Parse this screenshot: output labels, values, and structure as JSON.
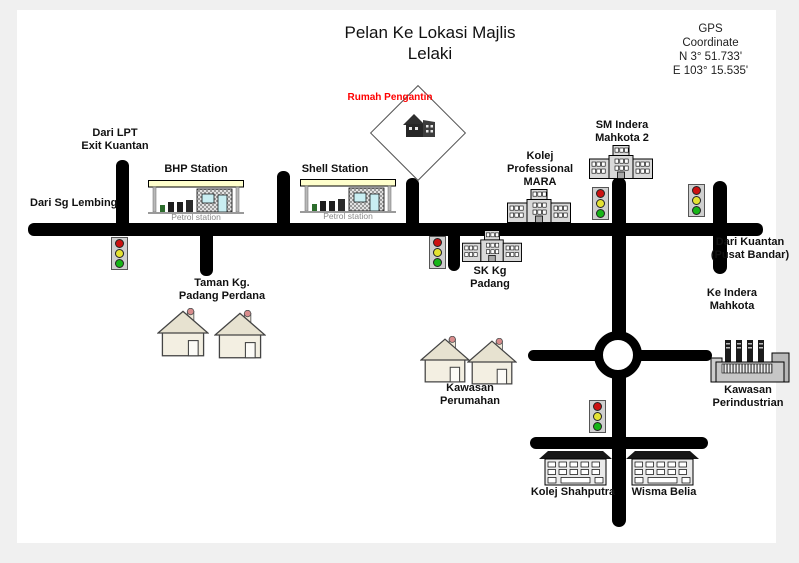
{
  "title": "Pelan Ke Lokasi Majlis\nLelaki",
  "gps_coordinate": "GPS\nCoordinate\nN 3° 51.733'\nE 103° 15.535'",
  "labels": {
    "dari_lpt": "Dari LPT\nExit Kuantan",
    "dari_sg_lembing": "Dari Sg Lembing",
    "bhp_station": "BHP Station",
    "shell_station": "Shell Station",
    "petrol_station": "Petrol station",
    "rumah_pengantin": "Rumah Pengantin",
    "taman_kg_padang_perdana": "Taman Kg.\nPadang Perdana",
    "kolej_professional_mara": "Kolej\nProfessional\nMARA",
    "sm_indera_mahkota_2": "SM Indera\nMahkota 2",
    "sk_kg_padang": "SK Kg\nPadang",
    "dari_kuantan_pusat_bandar": "Dari Kuantan\n(Pusat Bandar)",
    "ke_indera_mahkota": "Ke Indera\nMahkota",
    "kawasan_perumahan": "Kawasan\nPerumahan",
    "kawasan_perindustrian": "Kawasan\nPerindustrian",
    "kolej_shahputra": "Kolej Shahputra",
    "wisma_belia": "Wisma Belia"
  },
  "colors": {
    "road": "#000000",
    "highlight_label_red": "#ff0000",
    "petrol_canopy_yellow": "#ffffcc",
    "traffic_light_red": "#cc1111",
    "traffic_light_yellow": "#e4e232",
    "traffic_light_green": "#17b517",
    "building_gray": "#d9d9d9"
  },
  "icons": {
    "traffic_light": "red-yellow-green signal (5 on map)",
    "petrol_station": "canopy with pumps and shop (BHP, Shell)",
    "school_building": "gray 3-block school (MARA, SM Indera Mahkota 2, SK Kg Padang)",
    "house": "gabled house with chimney (4 on map)",
    "factory": "industrial building with 4 chimneys",
    "college_building": "multi-storey block (Kolej Shahputra, Wisma Belia)",
    "wedding_house_diamond": "diamond sign with dark house clipart (Rumah Pengantin)",
    "roundabout": "circular junction"
  }
}
